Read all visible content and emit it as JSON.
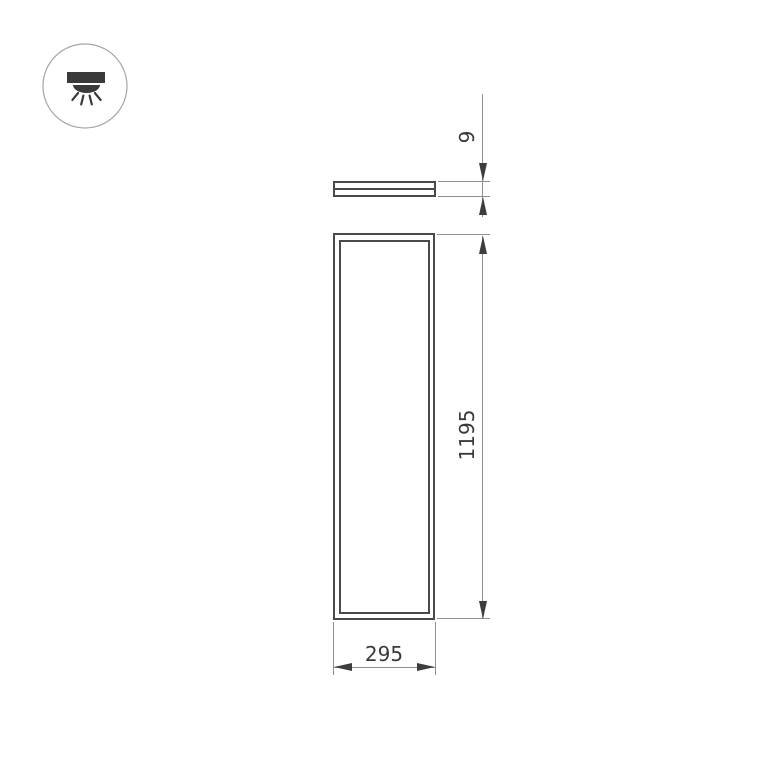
{
  "drawing": {
    "type": "technical-dimension-drawing",
    "subject": "rectangular LED panel luminaire, front view and edge (side) view",
    "icon_badge": {
      "name": "ceiling-downlight-icon",
      "description": "circled surface-mount light fixture emitting light downward"
    },
    "side_view": {
      "thickness_label": "9"
    },
    "front_view": {
      "height_label": "1195",
      "width_label": "295"
    },
    "dimensions_mm": {
      "width": 295,
      "height": 1195,
      "thickness": 9
    },
    "colors": {
      "background": "#ffffff",
      "outline_dark": "#4a4a4a",
      "dimension_gray": "#8f8f8f",
      "arrow_text": "#3a3a3a",
      "icon_stroke": "#a5a5a5",
      "icon_fill": "#3a3a3a"
    }
  }
}
